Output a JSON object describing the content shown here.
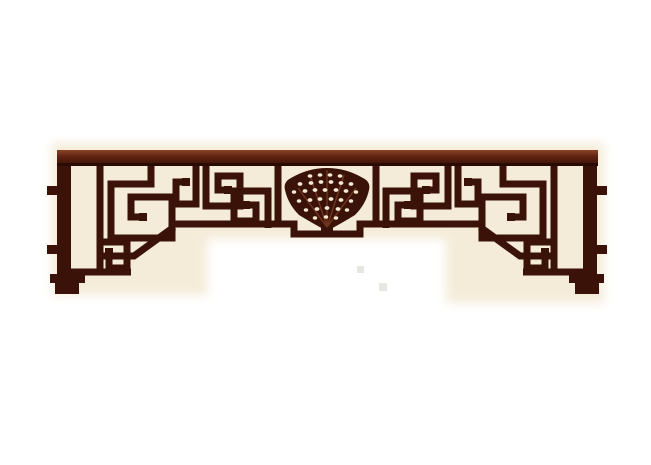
{
  "figure": {
    "alt_text": "Antique Chinese carved wooden openwork transom panel (gua luo) with rectangular meander fretwork, corner braces, end posts with stepped feet and tenons, and a central pierced fan-shaped medallion, rendered in dark reddish-brown wood on a plain white background",
    "object": "chinese-lattice-transom-panel"
  },
  "palette": {
    "background": "#ffffff",
    "halo_cream": "#f3e8d2",
    "wood_dark": "#3b1208",
    "wood_mid": "#5a2110",
    "wood_highlight": "#8a4527",
    "rail_edge_dark": "#2a0b04",
    "artifact_gray": "#dcdad3"
  }
}
